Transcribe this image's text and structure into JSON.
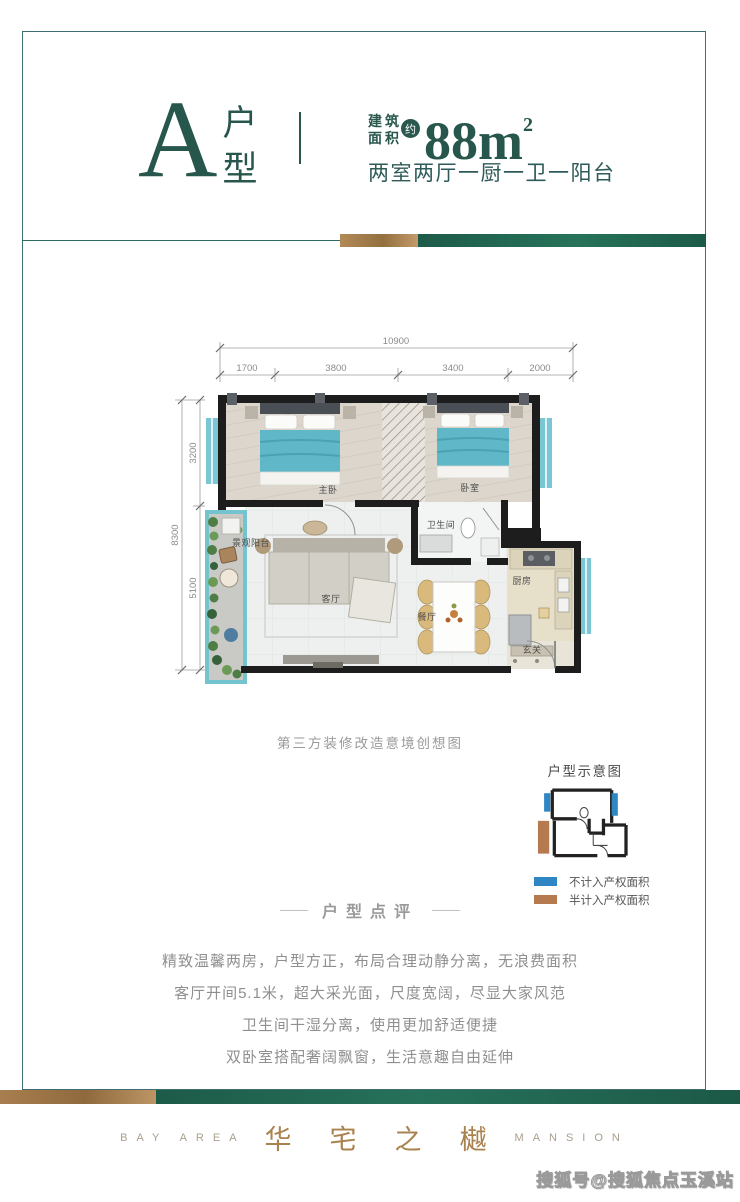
{
  "header": {
    "type_letter": "A",
    "type_char_top": "户",
    "type_char_bottom": "型",
    "area_prefix_line1": "建筑",
    "area_prefix_line2": "面积",
    "area_approx": "约",
    "area_value": "88",
    "area_unit": "m",
    "area_sup": "2",
    "layout_desc": "两室两厅一厨一卫一阳台"
  },
  "floorplan": {
    "dims_top": {
      "total": "10900",
      "seg1": "1700",
      "seg2": "3800",
      "seg3": "3400",
      "seg4": "2000"
    },
    "dims_left": {
      "total": "8300",
      "seg1": "3200",
      "seg2": "5100"
    },
    "rooms": {
      "master": "主卧",
      "bedroom": "卧室",
      "bath": "卫生间",
      "living": "客厅",
      "dining": "餐厅",
      "kitchen": "厨房",
      "entry": "玄关",
      "balcony": "景观阳台"
    },
    "caption": "第三方装修改造意境创想图"
  },
  "schematic": {
    "title": "户型示意图",
    "legend_blue": "不计入产权面积",
    "legend_brown": "半计入产权面积"
  },
  "review": {
    "title": "户型点评",
    "lines": [
      "精致温馨两房，户型方正，布局合理动静分离，无浪费面积",
      "客厅开间5.1米，超大采光面，尺度宽阔，尽显大家风范",
      "卫生间干湿分离，使用更加舒适便捷",
      "双卧室搭配奢阔飘窗，生活意趣自由延伸"
    ]
  },
  "footer": {
    "brand_left": "BAY AREA",
    "brand_center": "华宅之樾",
    "brand_right": "MANSION"
  },
  "watermark": "搜狐号@搜狐焦点玉溪站",
  "colors": {
    "accent_teal": "#2a574e",
    "bar_green": "#1f5f4c",
    "bar_gold": "#a87e4f",
    "window_blue": "#2e86c3",
    "balcony_brown": "#b57a4e",
    "bed_teal": "#5fb7c8"
  }
}
